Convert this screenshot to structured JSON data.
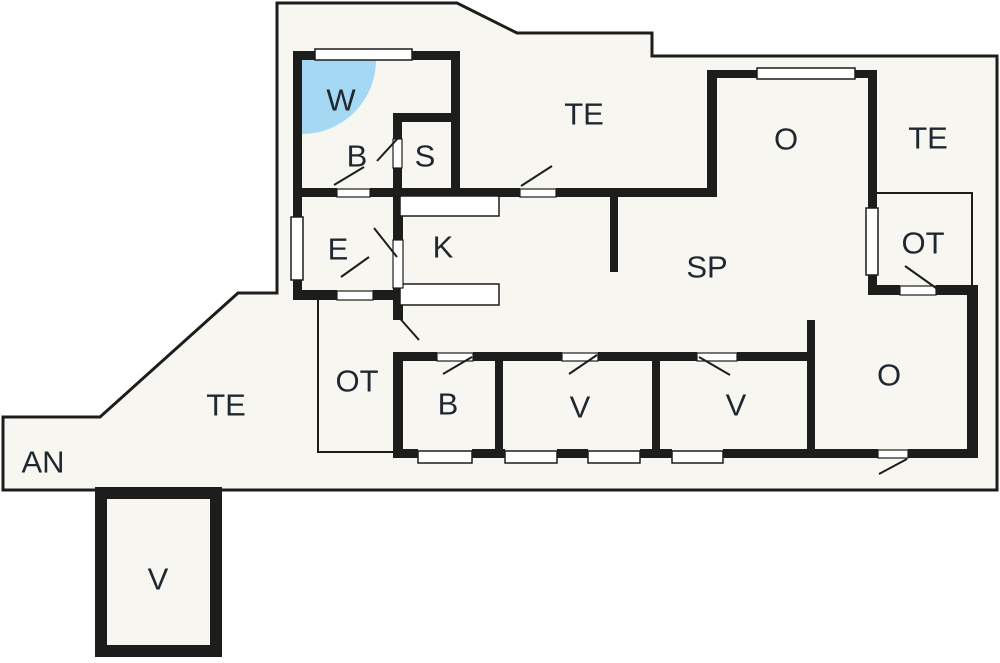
{
  "plan": {
    "type": "holiday-home floor plan",
    "colors": {
      "outside": "#ffffff",
      "site_fill": "#f7f6f0",
      "wall": "#1d1d1b",
      "spa": "#a5d8f2",
      "label": "#1f2731"
    },
    "rooms": [
      {
        "id": "w-spa",
        "label": "W"
      },
      {
        "id": "bath",
        "label": "B"
      },
      {
        "id": "sauna",
        "label": "S"
      },
      {
        "id": "terrace-top",
        "label": "TE"
      },
      {
        "id": "living-top",
        "label": "O"
      },
      {
        "id": "terrace-right",
        "label": "TE"
      },
      {
        "id": "covered-terrace-right",
        "label": "OT"
      },
      {
        "id": "entry",
        "label": "E"
      },
      {
        "id": "kitchen",
        "label": "K"
      },
      {
        "id": "living-dining",
        "label": "SP"
      },
      {
        "id": "covered-terrace-left",
        "label": "OT"
      },
      {
        "id": "bedroom-b",
        "label": "B"
      },
      {
        "id": "bedroom-v1",
        "label": "V"
      },
      {
        "id": "bedroom-v2",
        "label": "V"
      },
      {
        "id": "living-bottom",
        "label": "O"
      },
      {
        "id": "terrace-left",
        "label": "TE"
      },
      {
        "id": "annex-area",
        "label": "AN"
      },
      {
        "id": "annex-room",
        "label": "V"
      }
    ]
  }
}
